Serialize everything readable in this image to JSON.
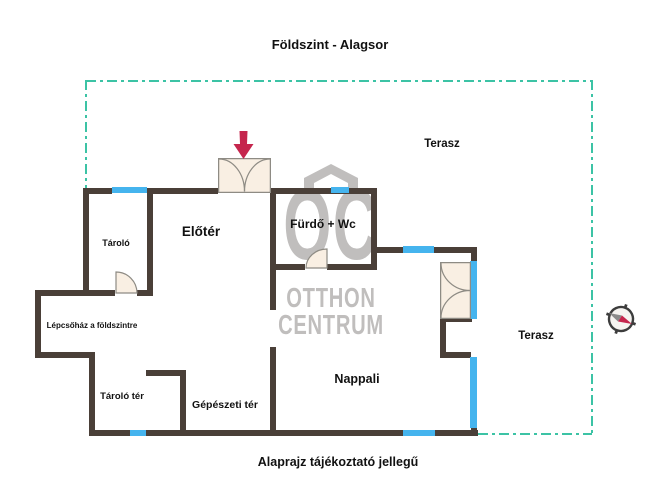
{
  "title": "Földszint - Alagsor",
  "footer": "Alaprajz tájékoztató jellegű",
  "rooms": {
    "eloter": "Előtér",
    "tarolo": "Tároló",
    "furdo_wc": "Fürdő + Wc",
    "terasz_top": "Terasz",
    "terasz_right": "Terasz",
    "lepcsohaz": "Lépcsőház a földszintre",
    "tarolo_ter": "Tároló tér",
    "gepeszeti_ter": "Gépészeti tér",
    "nappali": "Nappali"
  },
  "watermark": {
    "monogram": "OC",
    "line1": "OTTHON",
    "line2": "CENTRUM"
  },
  "icons": {
    "entrance_arrow": "red-down-arrow",
    "compass": "compass-rose",
    "logo_roof": "house-roof"
  },
  "colors": {
    "wall": "#4a3f38",
    "window": "#45b4ee",
    "terrace": "#3cc3a5",
    "door_fill": "#f9efe3",
    "door_stroke": "#8e8b84",
    "arrow": "#c5264d",
    "watermark": "#c0bebd",
    "text": "#111111",
    "compass_gray": "#8b8b8b",
    "compass_ring": "#3d3d3d"
  }
}
